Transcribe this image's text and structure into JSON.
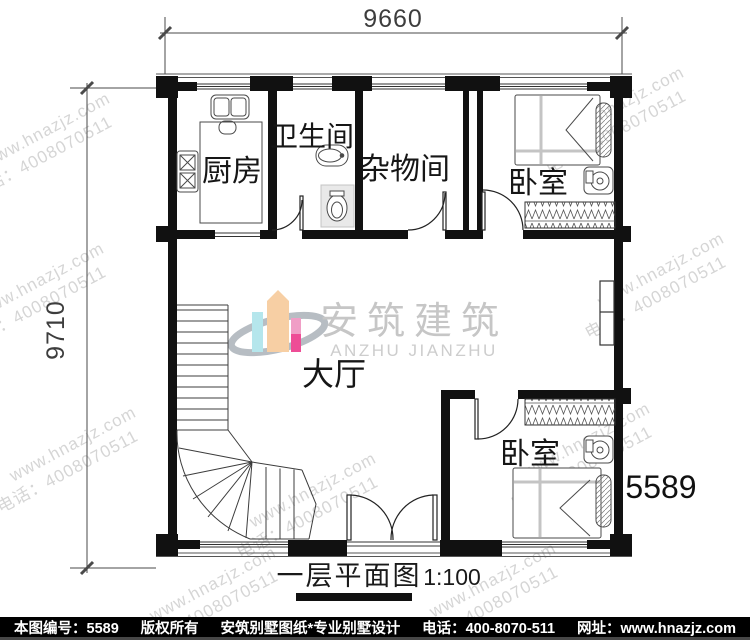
{
  "drawing": {
    "title": "一层平面图",
    "scale": "1:100",
    "plan_number": "5589",
    "dimensions": {
      "top_width": "9660",
      "left_height": "9710"
    },
    "rooms": {
      "kitchen": "厨房",
      "bathroom": "卫生间",
      "storage": "杂物间",
      "bedroom_top": "卧室",
      "bedroom_bottom": "卧室",
      "hall": "大厅"
    }
  },
  "logo": {
    "cn": "安筑建筑",
    "en": "ANZHU JIANZHU",
    "colors": {
      "cyan": "#b5e6ec",
      "peach": "#f7cfa4",
      "pink": "#f09ec6",
      "magenta": "#ee4d96",
      "swoosh": "#b7bdc3"
    }
  },
  "watermark": {
    "site": "www.hnazjz.com",
    "phone": "电话：4008070511"
  },
  "footer": {
    "sheet_no": "本图编号：5589",
    "copyright": "版权所有",
    "brand": "安筑别墅图纸*专业别墅设计",
    "phone": "电话：400-8070-511",
    "website": "网址：www.hnazjz.com",
    "bg": "#000000",
    "fg": "#ffffff"
  }
}
